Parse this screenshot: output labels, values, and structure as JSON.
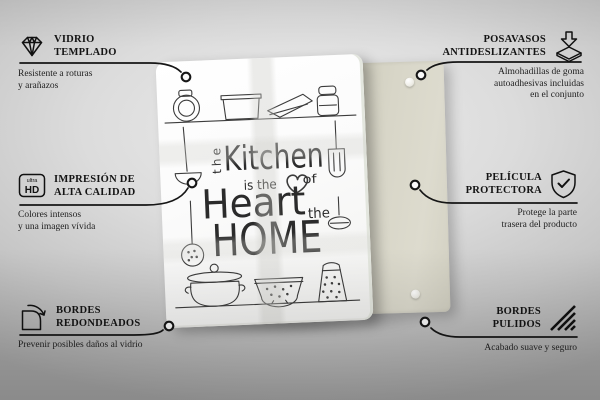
{
  "scene": {
    "design": {
      "the_vertical": "the",
      "kitchen": "Kitchen",
      "is_the": "is the",
      "of": "of",
      "heart": "Heart",
      "the_small": "the",
      "home": "HOME"
    }
  },
  "callouts": {
    "tempered_glass": {
      "icon": "diamond-icon",
      "title1": "VIDRIO",
      "title2": "TEMPLADO",
      "sub1": "Resistente a roturas",
      "sub2": "y arañazos"
    },
    "coasters": {
      "icon": "coaster-pads-icon",
      "title1": "POSAVASOS",
      "title2": "ANTIDESLIZANTES",
      "sub1": "Almohadillas de goma",
      "sub2": "autoadhesivas incluidas",
      "sub3": "en el conjunto"
    },
    "print": {
      "icon": "ultra-hd-icon",
      "icon_top": "ultra",
      "icon_bottom": "HD",
      "title1": "IMPRESIÓN DE",
      "title2": "ALTA CALIDAD",
      "sub1": "Colores intensos",
      "sub2": "y una imagen vívida"
    },
    "film": {
      "icon": "shield-check-icon",
      "title1": "PELÍCULA",
      "title2": "PROTECTORA",
      "sub1": "Protege la parte",
      "sub2": "trasera del producto"
    },
    "rounded": {
      "icon": "rounded-corner-icon",
      "title1": "BORDES",
      "title2": "REDONDEADOS",
      "sub1": "Prevenir posibles daños al vidrio"
    },
    "polished": {
      "icon": "polished-edge-icon",
      "title1": "BORDES",
      "title2": "PULIDOS",
      "sub1": "Acabado suave y seguro"
    }
  },
  "colors": {
    "line": "#161616",
    "back_panel": "#d7d5c7",
    "glass": "#fcfcfc",
    "text": "#1b1b1b"
  }
}
